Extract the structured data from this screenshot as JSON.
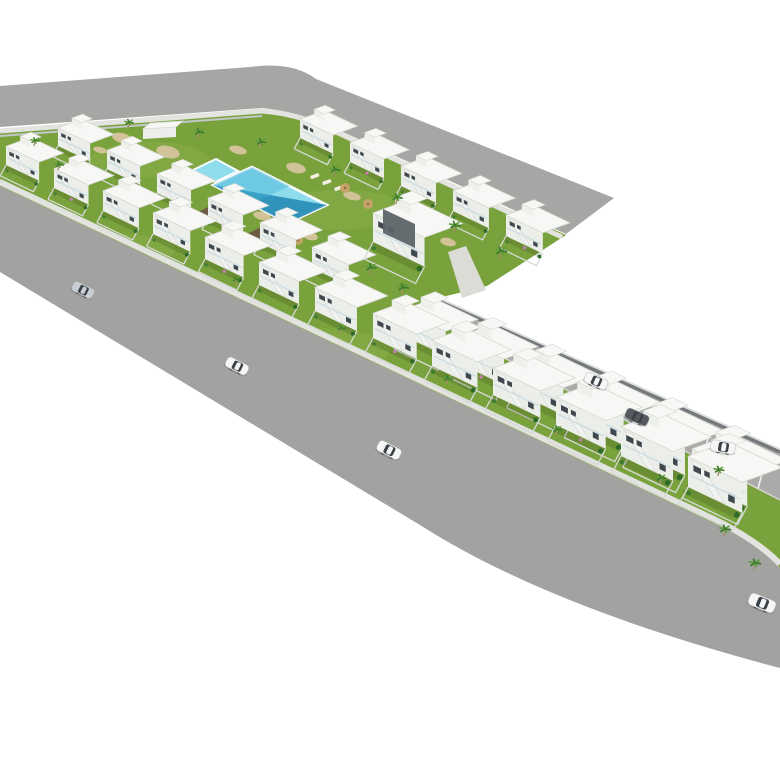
{
  "scene": {
    "kind": "3d-architectural-aerial-render",
    "description": "Aerial axonometric rendering of an L-shaped residential development of white two-storey townhouses with communal lawn, swimming pool, palm trees, perimeter roads with cars and a parking street",
    "background": "#ffffff",
    "width": 780,
    "height": 780
  },
  "palette": {
    "road": "#a6a6a4",
    "road2": "#a2a2a0",
    "sidewalk": "#e3e3e0",
    "garden_wall": "#dfe2df",
    "fence": "#c2c8ca",
    "parking": "#abaaa8",
    "parking_line": "#efefec",
    "wall_dark": "#75797c",
    "wall_light": "#d6d9da",
    "grass": "#7aa23c",
    "grass_light": "#8ab04a",
    "face": "#eceee9",
    "face_shadow": "#dde0db",
    "roof": "#f7f8f5",
    "roof_edge": "#d4d7d2",
    "tower": "#eef0ec",
    "window": "#3f484e",
    "stair": "#f1f3f0",
    "railing": "#cfe0e4",
    "pool_light": "#8edcec",
    "pool_mid": "#46b3d6",
    "pool_dark": "#1f86b4",
    "pool_coping": "#fbfdfd",
    "deck_brown": "#6f5c44",
    "sand": "#d8c5a0",
    "palm_dark": "#3c7a2b",
    "palm_light": "#5d9b3c",
    "trunk": "#a48d66",
    "shrub": "#2e6b28",
    "flower": "#c47fae",
    "path": "#dcdcd6",
    "car_white": "#f5f6f5",
    "car_silver": "#c9ced2",
    "car_dark": "#555a5f",
    "car_window": "#3a4147",
    "shadow": "rgba(0,0,0,0.13)"
  },
  "roads": {
    "top_road_path": "M0,86 L250,67 Q292,61 316,79 L614,198 L566,234 L332,127 Q300,112 262,108 L0,127 Z",
    "main_road_path": "M0,186 L722,527 Q762,547 780,568 L780,668 Q548,607 420,525 L0,272 Z",
    "top_sidewalk_path": "M0,131 L262,111 Q300,114 334,131 L562,237",
    "main_sidewalk_path": "M0,182 L722,523 Q760,543 780,564",
    "garden_wall_path": "M0,180 L730,525",
    "top_fence_path": "M0,136 L262,116"
  },
  "site": {
    "outline_path": "M0,131 L262,111 Q300,114 334,131 L566,235 L487,286 L434,299 L780,452 L780,568 Q762,547 722,527 L0,186 Z",
    "light_spots": [
      [
        150,
        160,
        60,
        18
      ],
      [
        340,
        210,
        70,
        20
      ],
      [
        120,
        250,
        55,
        16
      ],
      [
        320,
        350,
        70,
        22
      ],
      [
        520,
        470,
        80,
        24
      ],
      [
        660,
        520,
        60,
        20
      ]
    ]
  },
  "parking": {
    "strip_polygon": [
      [
        434,
        299
      ],
      [
        780,
        452
      ],
      [
        780,
        500
      ],
      [
        456,
        333
      ]
    ],
    "upper_wall": [
      [
        434,
        299
      ],
      [
        780,
        452
      ]
    ],
    "lower_wall": [
      [
        456,
        333
      ],
      [
        780,
        500
      ]
    ],
    "bay_count": 11,
    "bay_start_x": 478,
    "bay_step": 28
  },
  "walkway": {
    "path_polygon": [
      [
        448,
        252
      ],
      [
        466,
        246
      ],
      [
        486,
        290
      ],
      [
        462,
        298
      ]
    ]
  },
  "pool_area": {
    "main_pool": [
      [
        213,
        185
      ],
      [
        252,
        167
      ],
      [
        327,
        205
      ],
      [
        288,
        223
      ]
    ],
    "deep_triangle": [
      [
        213,
        185
      ],
      [
        288,
        223
      ],
      [
        327,
        205
      ]
    ],
    "kids_pool": [
      [
        193,
        170
      ],
      [
        216,
        159
      ],
      [
        238,
        171
      ],
      [
        215,
        182
      ]
    ],
    "decks": [
      [
        [
          196,
          213
        ],
        [
          216,
          203
        ],
        [
          230,
          210
        ],
        [
          210,
          220
        ]
      ],
      [
        [
          243,
          236
        ],
        [
          263,
          226
        ],
        [
          277,
          233
        ],
        [
          257,
          243
        ]
      ]
    ],
    "loungers": [
      [
        310,
        176
      ],
      [
        322,
        182
      ],
      [
        334,
        188
      ]
    ],
    "umbrellas": [
      [
        345,
        188
      ],
      [
        368,
        204
      ],
      [
        298,
        240
      ],
      [
        416,
        248
      ]
    ]
  },
  "vegetation": {
    "palms": [
      [
        34,
        146,
        0.7
      ],
      [
        58,
        170,
        0.7
      ],
      [
        128,
        128,
        0.72
      ],
      [
        198,
        138,
        0.78
      ],
      [
        260,
        148,
        0.78
      ],
      [
        334,
        176,
        0.82
      ],
      [
        396,
        204,
        0.85
      ],
      [
        454,
        232,
        0.88
      ],
      [
        500,
        258,
        0.9
      ],
      [
        370,
        274,
        0.85
      ],
      [
        402,
        294,
        0.85
      ],
      [
        235,
        284,
        0.6
      ],
      [
        340,
        333,
        0.65
      ],
      [
        447,
        384,
        0.7
      ],
      [
        556,
        435,
        0.75
      ],
      [
        660,
        484,
        0.8
      ],
      [
        724,
        536,
        0.9
      ],
      [
        754,
        570,
        0.9
      ],
      [
        718,
        476,
        0.8
      ]
    ],
    "sand_patches": [
      [
        122,
        138,
        10,
        5
      ],
      [
        168,
        152,
        12,
        6
      ],
      [
        238,
        150,
        9,
        4
      ],
      [
        296,
        168,
        10,
        5
      ],
      [
        352,
        196,
        9,
        4
      ],
      [
        405,
        222,
        9,
        4
      ],
      [
        448,
        242,
        8,
        4
      ],
      [
        262,
        216,
        9,
        4
      ],
      [
        310,
        236,
        8,
        4
      ],
      [
        100,
        150,
        7,
        3
      ]
    ]
  },
  "building_rows": [
    {
      "name": "courtyard-back-row",
      "facing": "sw",
      "units": [
        [
          58,
          146,
          0.7
        ],
        [
          107,
          169,
          0.72
        ],
        [
          157,
          193,
          0.74
        ],
        [
          208,
          218,
          0.76
        ],
        [
          260,
          243,
          0.78
        ],
        [
          312,
          268,
          0.8
        ]
      ]
    },
    {
      "name": "top-road-row",
      "facing": "sw",
      "units": [
        [
          300,
          138,
          0.72
        ],
        [
          350,
          162,
          0.74
        ],
        [
          401,
          186,
          0.76
        ],
        [
          453,
          211,
          0.78
        ],
        [
          506,
          236,
          0.8
        ]
      ]
    },
    {
      "name": "wing-back-row",
      "facing": "sw",
      "units": [
        [
          402,
          335,
          0.95
        ],
        [
          458,
          363,
          1.0
        ],
        [
          515,
          392,
          1.05
        ],
        [
          573,
          421,
          1.1
        ],
        [
          632,
          450,
          1.15
        ],
        [
          692,
          480,
          1.2
        ]
      ]
    },
    {
      "name": "front-row",
      "facing": "sw",
      "units": [
        [
          6,
          165,
          0.72
        ],
        [
          54,
          188,
          0.75
        ],
        [
          103,
          211,
          0.78
        ],
        [
          153,
          234,
          0.81
        ],
        [
          205,
          259,
          0.84
        ],
        [
          259,
          285,
          0.87
        ],
        [
          315,
          311,
          0.91
        ],
        [
          373,
          338,
          0.95
        ],
        [
          432,
          366,
          0.99
        ],
        [
          493,
          395,
          1.03
        ],
        [
          556,
          425,
          1.08
        ],
        [
          621,
          456,
          1.13
        ],
        [
          688,
          487,
          1.18
        ]
      ]
    }
  ],
  "clubhouse": {
    "x": 373,
    "y": 242,
    "s": 1.12,
    "panel": [
      [
        383,
        233
      ],
      [
        415,
        248
      ],
      [
        415,
        224
      ],
      [
        383,
        209
      ]
    ]
  },
  "small_structure": {
    "front": [
      [
        143,
        129
      ],
      [
        176,
        127
      ],
      [
        176,
        137
      ],
      [
        143,
        139
      ]
    ],
    "roof": [
      [
        143,
        129
      ],
      [
        176,
        127
      ],
      [
        183,
        121
      ],
      [
        150,
        123
      ]
    ]
  },
  "cars": [
    {
      "x": 83,
      "y": 290,
      "color": "silver",
      "angle": 27
    },
    {
      "x": 237,
      "y": 366,
      "color": "white",
      "angle": 27
    },
    {
      "x": 389,
      "y": 450,
      "color": "white",
      "angle": 27
    },
    {
      "x": 596,
      "y": 381,
      "color": "white",
      "angle": 24
    },
    {
      "x": 637,
      "y": 417,
      "color": "dark",
      "angle": 24
    },
    {
      "x": 723,
      "y": 447,
      "color": "white",
      "angle": 10
    },
    {
      "x": 762,
      "y": 603,
      "color": "white",
      "angle": 22
    }
  ]
}
